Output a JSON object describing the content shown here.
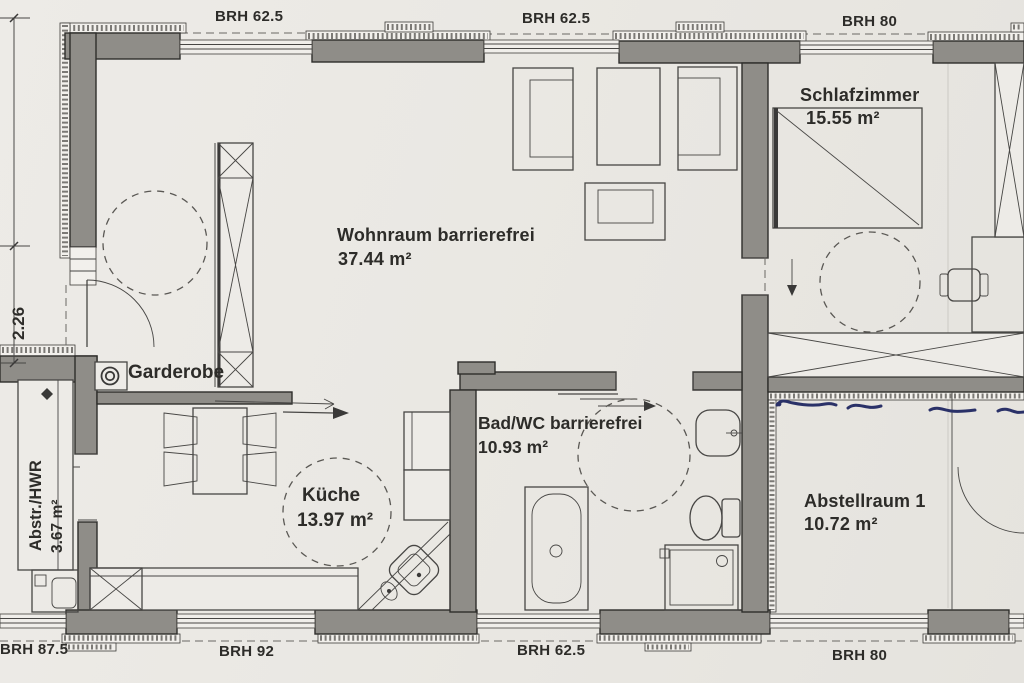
{
  "plan": {
    "title": "Grundriss (Scan) – barrierefreie Wohnung",
    "rooms": [
      {
        "name": "Wohnraum barrierefrei",
        "area": "37.44 m²"
      },
      {
        "name": "Schlafzimmer",
        "area": "15.55 m²"
      },
      {
        "name": "Küche",
        "area": "13.97 m²"
      },
      {
        "name": "Bad/WC barrierefrei",
        "area": "10.93 m²"
      },
      {
        "name": "Abstellraum 1",
        "area": "10.72 m²"
      },
      {
        "name": "Abstr./HWR",
        "area": "3.67 m²"
      },
      {
        "name": "Garderobe"
      }
    ],
    "brh_top": [
      "BRH 62.5",
      "BRH 62.5",
      "BRH 80"
    ],
    "brh_bottom": [
      "BRH 87.5",
      "BRH 92",
      "BRH 62.5",
      "BRH 80"
    ],
    "dimension_left": "2.26",
    "colors": {
      "paper": "#eae8e3",
      "wall": "#8f8d88",
      "line": "#3a3938",
      "pen_annotation": "#2a3168"
    }
  }
}
